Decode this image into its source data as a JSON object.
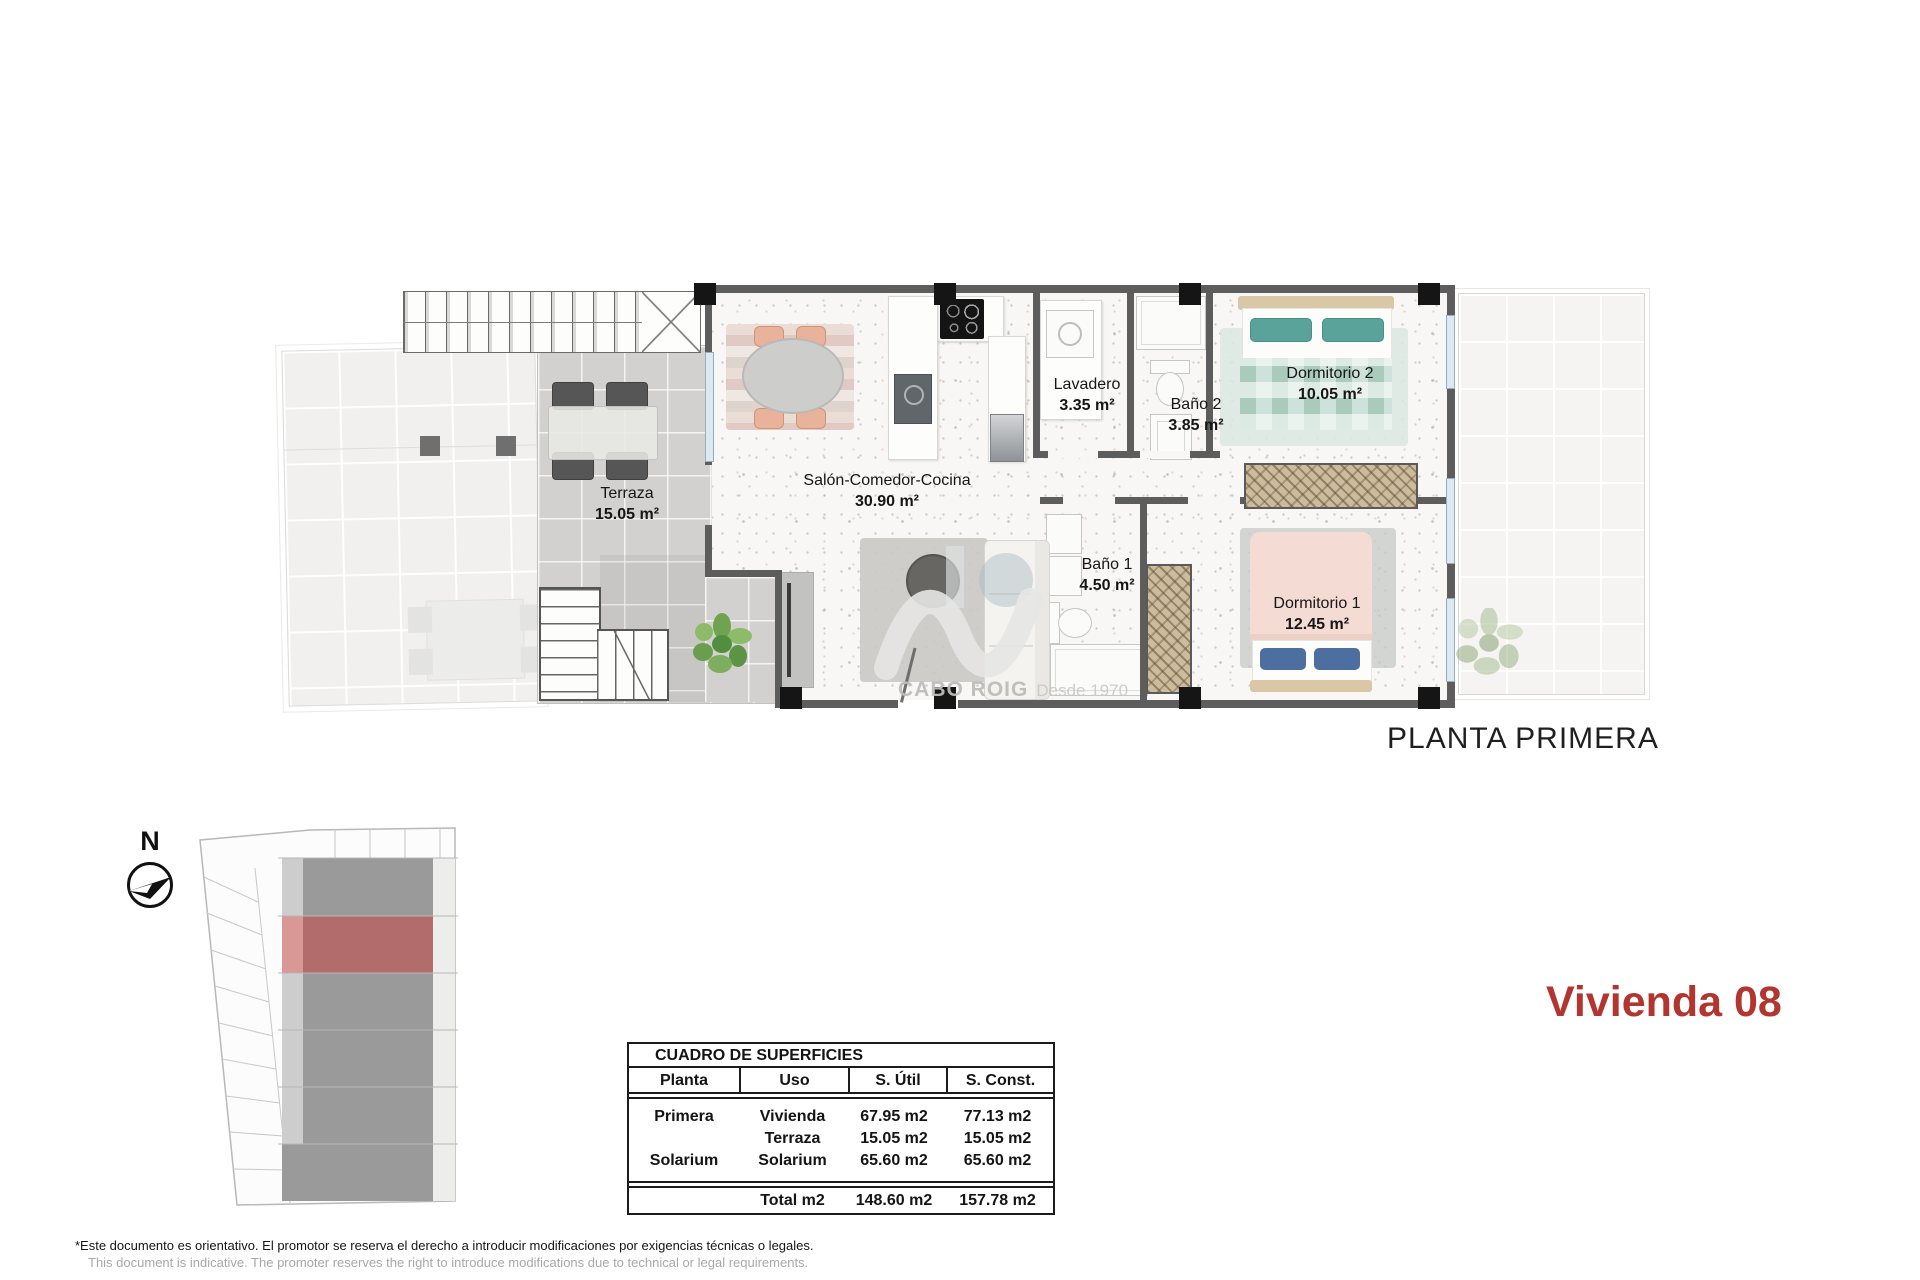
{
  "titles": {
    "plan": "PLANTA PRIMERA",
    "unit": "Vivienda 08"
  },
  "compass": {
    "label": "N"
  },
  "watermark": {
    "brand": "CABO ROIG",
    "tagline": "Desde 1970"
  },
  "rooms": [
    {
      "name": "Terraza",
      "area": "15.05 m²"
    },
    {
      "name": "Salón-Comedor-Cocina",
      "area": "30.90 m²"
    },
    {
      "name": "Lavadero",
      "area": "3.35 m²"
    },
    {
      "name": "Baño 2",
      "area": "3.85 m²"
    },
    {
      "name": "Dormitorio 2",
      "area": "10.05 m²"
    },
    {
      "name": "Baño 1",
      "area": "4.50 m²"
    },
    {
      "name": "Dormitorio 1",
      "area": "12.45 m²"
    }
  ],
  "surface_table": {
    "title": "CUADRO DE SUPERFICIES",
    "columns": [
      "Planta",
      "Uso",
      "S. Útil",
      "S. Const."
    ],
    "rows": [
      {
        "planta": "Primera",
        "uso": "Vivienda",
        "util": "67.95 m2",
        "const": "77.13 m2"
      },
      {
        "planta": "",
        "uso": "Terraza",
        "util": "15.05 m2",
        "const": "15.05 m2"
      },
      {
        "planta": "Solarium",
        "uso": "Solarium",
        "util": "65.60 m2",
        "const": "65.60 m2"
      }
    ],
    "total": {
      "label": "Total m2",
      "util": "148.60 m2",
      "const": "157.78 m2"
    }
  },
  "disclaimer": {
    "es": "*Este documento es orientativo. El promotor se reserva el derecho a introducir modificaciones por exigencias técnicas o legales.",
    "en": "This document is indicative. The promoter reserves the right to introduce modifications due to technical or legal requirements."
  },
  "colors": {
    "accent_red": "#b23530",
    "site_highlight_red": "#b26c6c",
    "wall_gray": "#5d5d5d",
    "site_block_gray": "#9a9a9a"
  }
}
